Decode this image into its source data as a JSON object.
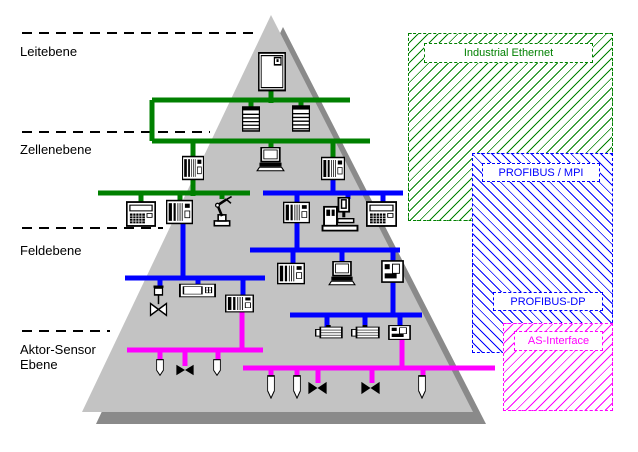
{
  "colors": {
    "ethernet": "#008000",
    "profibus": "#0000ff",
    "asi": "#ff00ff",
    "pyramid_fill": "#c3c3c3",
    "pyramid_shadow": "#8a8a8a",
    "line": "#000000"
  },
  "levels": [
    {
      "lines": [
        "Leitebene"
      ],
      "text_x": 20,
      "text_y": 44,
      "sep": {
        "x1": 22,
        "y": 33,
        "x2": 253
      }
    },
    {
      "lines": [
        "Zellenebene"
      ],
      "text_x": 20,
      "text_y": 142,
      "sep": {
        "x1": 22,
        "y": 132,
        "x2": 210
      }
    },
    {
      "lines": [
        "Feldebene"
      ],
      "text_x": 20,
      "text_y": 243,
      "sep": {
        "x1": 22,
        "y": 228,
        "x2": 163
      }
    },
    {
      "lines": [
        "Aktor-Sensor",
        "Ebene"
      ],
      "text_x": 20,
      "text_y": 342,
      "sep": {
        "x1": 22,
        "y": 331,
        "x2": 110
      }
    }
  ],
  "pyramid": {
    "shadow_points": "283,27 96,424 486,424",
    "main_points": "271,15 82,412 473,412"
  },
  "buses": [
    {
      "net": "ethernet",
      "x1": 152,
      "y1": 100,
      "x2": 350,
      "y2": 100
    },
    {
      "net": "ethernet",
      "x1": 152,
      "y1": 141,
      "x2": 370,
      "y2": 141
    },
    {
      "net": "ethernet",
      "x1": 152,
      "y1": 100,
      "x2": 152,
      "y2": 141
    },
    {
      "net": "ethernet",
      "x1": 98,
      "y1": 193,
      "x2": 250,
      "y2": 193
    },
    {
      "net": "ethernet",
      "x1": 271,
      "y1": 89,
      "x2": 271,
      "y2": 103
    },
    {
      "net": "ethernet",
      "x1": 251,
      "y1": 100,
      "x2": 251,
      "y2": 108
    },
    {
      "net": "ethernet",
      "x1": 301,
      "y1": 100,
      "x2": 301,
      "y2": 107
    },
    {
      "net": "ethernet",
      "x1": 193,
      "y1": 141,
      "x2": 193,
      "y2": 157
    },
    {
      "net": "ethernet",
      "x1": 271,
      "y1": 141,
      "x2": 271,
      "y2": 149
    },
    {
      "net": "ethernet",
      "x1": 333,
      "y1": 141,
      "x2": 333,
      "y2": 158
    },
    {
      "net": "ethernet",
      "x1": 193,
      "y1": 180,
      "x2": 193,
      "y2": 196
    },
    {
      "net": "ethernet",
      "x1": 141,
      "y1": 193,
      "x2": 141,
      "y2": 203
    },
    {
      "net": "ethernet",
      "x1": 180,
      "y1": 193,
      "x2": 180,
      "y2": 201
    },
    {
      "net": "ethernet",
      "x1": 222,
      "y1": 193,
      "x2": 222,
      "y2": 199
    },
    {
      "net": "profibus",
      "x1": 263,
      "y1": 193,
      "x2": 403,
      "y2": 193
    },
    {
      "net": "profibus",
      "x1": 250,
      "y1": 250,
      "x2": 400,
      "y2": 250
    },
    {
      "net": "profibus",
      "x1": 125,
      "y1": 278,
      "x2": 265,
      "y2": 278
    },
    {
      "net": "profibus",
      "x1": 290,
      "y1": 315,
      "x2": 422,
      "y2": 315
    },
    {
      "net": "profibus",
      "x1": 333,
      "y1": 180,
      "x2": 333,
      "y2": 193
    },
    {
      "net": "profibus",
      "x1": 297,
      "y1": 193,
      "x2": 297,
      "y2": 203
    },
    {
      "net": "profibus",
      "x1": 348,
      "y1": 193,
      "x2": 348,
      "y2": 199
    },
    {
      "net": "profibus",
      "x1": 383,
      "y1": 193,
      "x2": 383,
      "y2": 203
    },
    {
      "net": "profibus",
      "x1": 297,
      "y1": 222,
      "x2": 297,
      "y2": 252
    },
    {
      "net": "profibus",
      "x1": 293,
      "y1": 250,
      "x2": 293,
      "y2": 263
    },
    {
      "net": "profibus",
      "x1": 342,
      "y1": 250,
      "x2": 342,
      "y2": 263
    },
    {
      "net": "profibus",
      "x1": 393,
      "y1": 250,
      "x2": 393,
      "y2": 262
    },
    {
      "net": "profibus",
      "x1": 183,
      "y1": 224,
      "x2": 183,
      "y2": 280
    },
    {
      "net": "profibus",
      "x1": 160,
      "y1": 278,
      "x2": 160,
      "y2": 288
    },
    {
      "net": "profibus",
      "x1": 198,
      "y1": 278,
      "x2": 198,
      "y2": 285
    },
    {
      "net": "profibus",
      "x1": 243,
      "y1": 278,
      "x2": 243,
      "y2": 296
    },
    {
      "net": "profibus",
      "x1": 393,
      "y1": 282,
      "x2": 393,
      "y2": 317
    },
    {
      "net": "profibus",
      "x1": 327,
      "y1": 315,
      "x2": 327,
      "y2": 327
    },
    {
      "net": "profibus",
      "x1": 365,
      "y1": 315,
      "x2": 365,
      "y2": 327
    },
    {
      "net": "profibus",
      "x1": 400,
      "y1": 315,
      "x2": 400,
      "y2": 327
    },
    {
      "net": "asi",
      "x1": 127,
      "y1": 350,
      "x2": 263,
      "y2": 350
    },
    {
      "net": "asi",
      "x1": 243,
      "y1": 368,
      "x2": 495,
      "y2": 368
    },
    {
      "net": "asi",
      "x1": 242,
      "y1": 311,
      "x2": 242,
      "y2": 352
    },
    {
      "net": "asi",
      "x1": 402,
      "y1": 338,
      "x2": 402,
      "y2": 370
    },
    {
      "net": "asi",
      "x1": 160,
      "y1": 350,
      "x2": 160,
      "y2": 361
    },
    {
      "net": "asi",
      "x1": 185,
      "y1": 350,
      "x2": 185,
      "y2": 366
    },
    {
      "net": "asi",
      "x1": 218,
      "y1": 350,
      "x2": 218,
      "y2": 361
    },
    {
      "net": "asi",
      "x1": 271,
      "y1": 368,
      "x2": 271,
      "y2": 377
    },
    {
      "net": "asi",
      "x1": 297,
      "y1": 368,
      "x2": 297,
      "y2": 377
    },
    {
      "net": "asi",
      "x1": 318,
      "y1": 368,
      "x2": 318,
      "y2": 383
    },
    {
      "net": "asi",
      "x1": 372,
      "y1": 368,
      "x2": 372,
      "y2": 383
    },
    {
      "net": "asi",
      "x1": 423,
      "y1": 368,
      "x2": 423,
      "y2": 377
    }
  ],
  "devices": [
    {
      "type": "cabinet",
      "x": 257,
      "y": 52,
      "w": 30,
      "h": 40
    },
    {
      "type": "rack",
      "x": 241,
      "y": 106,
      "w": 20,
      "h": 26
    },
    {
      "type": "rack",
      "x": 291,
      "y": 105,
      "w": 20,
      "h": 27
    },
    {
      "type": "plc",
      "x": 182,
      "y": 155,
      "w": 22,
      "h": 26
    },
    {
      "type": "laptop",
      "x": 256,
      "y": 147,
      "w": 29,
      "h": 27
    },
    {
      "type": "plc",
      "x": 321,
      "y": 156,
      "w": 24,
      "h": 25
    },
    {
      "type": "keypad",
      "x": 126,
      "y": 201,
      "w": 30,
      "h": 26
    },
    {
      "type": "plc",
      "x": 166,
      "y": 199,
      "w": 27,
      "h": 26
    },
    {
      "type": "robot",
      "x": 206,
      "y": 195,
      "w": 32,
      "h": 32
    },
    {
      "type": "plc",
      "x": 283,
      "y": 201,
      "w": 27,
      "h": 23
    },
    {
      "type": "cnc",
      "x": 321,
      "y": 197,
      "w": 38,
      "h": 35
    },
    {
      "type": "keypad",
      "x": 366,
      "y": 201,
      "w": 31,
      "h": 26
    },
    {
      "type": "plc",
      "x": 277,
      "y": 262,
      "w": 28,
      "h": 23
    },
    {
      "type": "laptop",
      "x": 328,
      "y": 261,
      "w": 28,
      "h": 27
    },
    {
      "type": "drive",
      "x": 381,
      "y": 260,
      "w": 23,
      "h": 23
    },
    {
      "type": "ctrlvalve",
      "x": 146,
      "y": 285,
      "w": 25,
      "h": 33
    },
    {
      "type": "panel",
      "x": 179,
      "y": 283,
      "w": 37,
      "h": 15
    },
    {
      "type": "plc",
      "x": 225,
      "y": 294,
      "w": 29,
      "h": 19
    },
    {
      "type": "motor",
      "x": 315,
      "y": 325,
      "w": 28,
      "h": 15
    },
    {
      "type": "motor",
      "x": 351,
      "y": 325,
      "w": 29,
      "h": 15
    },
    {
      "type": "drive",
      "x": 388,
      "y": 325,
      "w": 23,
      "h": 15
    },
    {
      "type": "sensor",
      "x": 154,
      "y": 359,
      "w": 12,
      "h": 17
    },
    {
      "type": "bowtie",
      "x": 176,
      "y": 364,
      "w": 18,
      "h": 12
    },
    {
      "type": "sensor",
      "x": 211,
      "y": 359,
      "w": 12,
      "h": 17
    },
    {
      "type": "sensor",
      "x": 265,
      "y": 375,
      "w": 12,
      "h": 24
    },
    {
      "type": "sensor",
      "x": 291,
      "y": 375,
      "w": 12,
      "h": 24
    },
    {
      "type": "bowtie",
      "x": 308,
      "y": 381,
      "w": 19,
      "h": 14
    },
    {
      "type": "bowtie",
      "x": 361,
      "y": 381,
      "w": 19,
      "h": 14
    },
    {
      "type": "sensor",
      "x": 416,
      "y": 375,
      "w": 12,
      "h": 24
    }
  ],
  "legend": {
    "boxes": [
      {
        "name": "industrial-ethernet-region",
        "net": "ethernet",
        "hatch": "fwd",
        "x": 408,
        "y": 33,
        "w": 205,
        "h": 188
      },
      {
        "name": "profibus-region",
        "net": "profibus",
        "hatch": "back",
        "x": 472,
        "y": 153,
        "w": 141,
        "h": 200
      },
      {
        "name": "as-interface-region",
        "net": "asi",
        "hatch": "fwd",
        "x": 503,
        "y": 323,
        "w": 110,
        "h": 88
      }
    ],
    "labels": [
      {
        "text": "Industrial Ethernet",
        "net": "ethernet",
        "x": 424,
        "y": 43,
        "w": 169,
        "h": 20
      },
      {
        "text": "PROFIBUS / MPI",
        "net": "profibus",
        "x": 482,
        "y": 163,
        "w": 118,
        "h": 19
      },
      {
        "text": "PROFIBUS-DP",
        "net": "profibus",
        "x": 493,
        "y": 292,
        "w": 110,
        "h": 19
      },
      {
        "text": "AS-Interface",
        "net": "asi",
        "x": 514,
        "y": 331,
        "w": 89,
        "h": 20
      }
    ]
  }
}
